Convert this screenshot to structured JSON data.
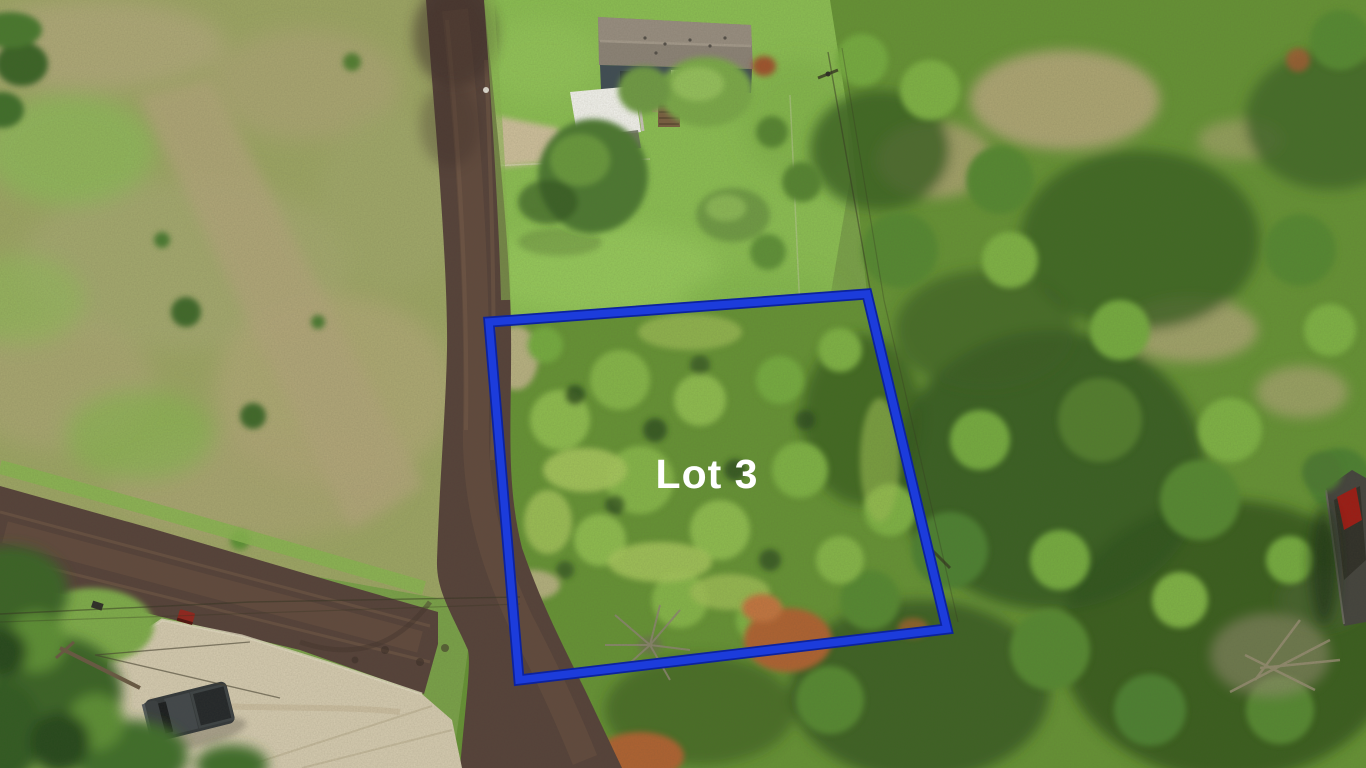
{
  "lot_annotation": {
    "label": "Lot 3",
    "boundary_color": "#1c3cdb",
    "boundary_shadow_color": "#0c229e",
    "label_color": "#ffffff"
  }
}
